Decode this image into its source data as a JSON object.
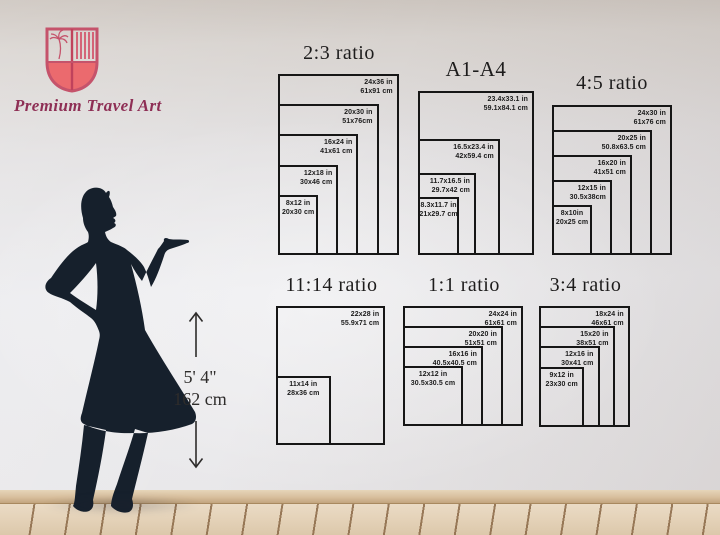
{
  "brand": {
    "name": "Premium Travel Art"
  },
  "person": {
    "height_ft": "5' 4\"",
    "height_cm": "162 cm"
  },
  "colors": {
    "diagram_line": "#161616",
    "silhouette": "#16202c",
    "logo_rose": "#c5536b",
    "logo_coral": "#eb6a6e",
    "brand_text": "#8e2f55"
  },
  "charts": [
    {
      "id": "ratio-2-3",
      "title": "2:3 ratio",
      "sizes": [
        {
          "in": "24x36 in",
          "cm": "61x91 cm",
          "w": 24,
          "h": 36
        },
        {
          "in": "20x30 in",
          "cm": "51x76cm",
          "w": 20,
          "h": 30
        },
        {
          "in": "16x24 in",
          "cm": "41x61 cm",
          "w": 16,
          "h": 24
        },
        {
          "in": "12x18 in",
          "cm": "30x46 cm",
          "w": 12,
          "h": 18
        },
        {
          "in": "8x12 in",
          "cm": "20x30 cm",
          "w": 8,
          "h": 12
        }
      ]
    },
    {
      "id": "a1-a4",
      "title": "A1-A4",
      "sizes": [
        {
          "in": "23.4x33.1 in",
          "cm": "59.1x84.1 cm",
          "w": 23.4,
          "h": 33.1
        },
        {
          "in": "16.5x23.4 in",
          "cm": "42x59.4 cm",
          "w": 16.5,
          "h": 23.4
        },
        {
          "in": "11.7x16.5 in",
          "cm": "29.7x42 cm",
          "w": 11.7,
          "h": 16.5
        },
        {
          "in": "8.3x11.7 in",
          "cm": "21x29.7 cm",
          "w": 8.3,
          "h": 11.7
        }
      ]
    },
    {
      "id": "ratio-4-5",
      "title": "4:5 ratio",
      "sizes": [
        {
          "in": "24x30 in",
          "cm": "61x76 cm",
          "w": 24,
          "h": 30
        },
        {
          "in": "20x25 in",
          "cm": "50.8x63.5 cm",
          "w": 20,
          "h": 25
        },
        {
          "in": "16x20 in",
          "cm": "41x51 cm",
          "w": 16,
          "h": 20
        },
        {
          "in": "12x15 in",
          "cm": "30.5x38cm",
          "w": 12,
          "h": 15
        },
        {
          "in": "8x10in",
          "cm": "20x25 cm",
          "w": 8,
          "h": 10
        }
      ]
    },
    {
      "id": "ratio-11-14",
      "title": "11:14 ratio",
      "sizes": [
        {
          "in": "22x28 in",
          "cm": "55.9x71 cm",
          "w": 22,
          "h": 28
        },
        {
          "in": "11x14 in",
          "cm": "28x36 cm",
          "w": 11,
          "h": 14
        }
      ]
    },
    {
      "id": "ratio-1-1",
      "title": "1:1 ratio",
      "sizes": [
        {
          "in": "24x24 in",
          "cm": "61x61 cm",
          "w": 24,
          "h": 24
        },
        {
          "in": "20x20 in",
          "cm": "51x51 cm",
          "w": 20,
          "h": 20
        },
        {
          "in": "16x16 in",
          "cm": "40.5x40.5 cm",
          "w": 16,
          "h": 16
        },
        {
          "in": "12x12 in",
          "cm": "30.5x30.5 cm",
          "w": 12,
          "h": 12
        }
      ]
    },
    {
      "id": "ratio-3-4",
      "title": "3:4 ratio",
      "sizes": [
        {
          "in": "18x24 in",
          "cm": "46x61 cm",
          "w": 18,
          "h": 24
        },
        {
          "in": "15x20 in",
          "cm": "38x51 cm",
          "w": 15,
          "h": 20
        },
        {
          "in": "12x16 in",
          "cm": "30x41 cm",
          "w": 12,
          "h": 16
        },
        {
          "in": "9x12 in",
          "cm": "23x30 cm",
          "w": 9,
          "h": 12
        }
      ]
    }
  ]
}
